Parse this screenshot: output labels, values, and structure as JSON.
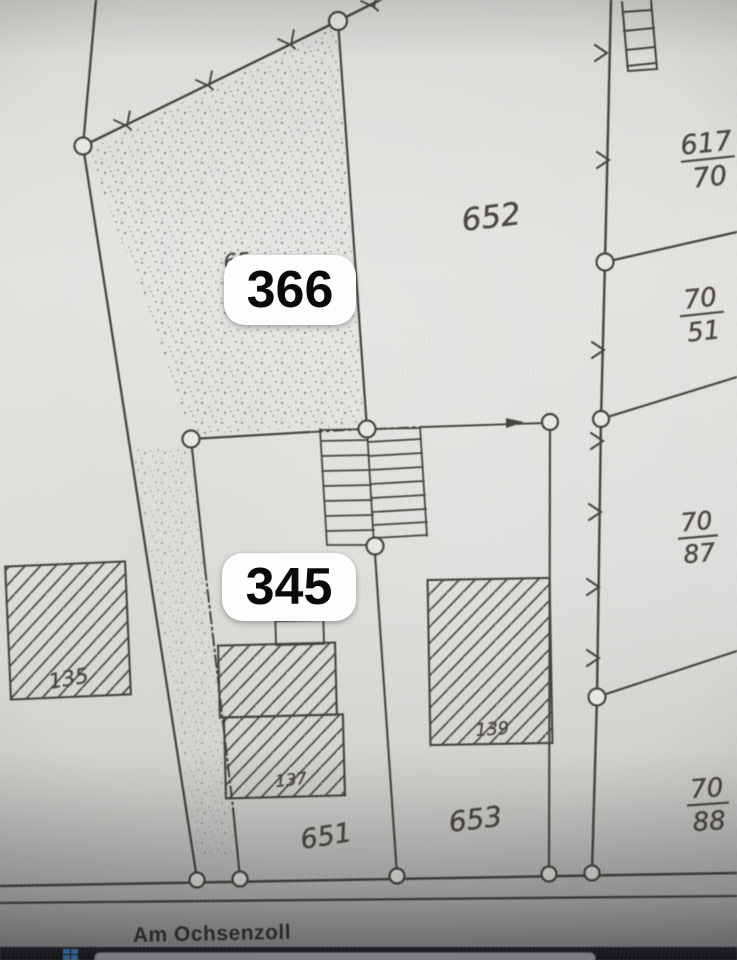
{
  "map": {
    "street_name": "Am Ochsenzoll",
    "annotation_pills": [
      {
        "text": "366"
      },
      {
        "text": "345"
      }
    ],
    "parcel_labels": [
      {
        "text": "652"
      },
      {
        "text": "651"
      },
      {
        "text": "653"
      }
    ],
    "partial_parcel_label": {
      "text": "65"
    },
    "fraction_labels": [
      {
        "numerator": "617",
        "denominator": "70"
      },
      {
        "numerator": "70",
        "denominator": "51"
      },
      {
        "numerator": "70",
        "denominator": "87"
      },
      {
        "numerator": "70",
        "denominator": "88"
      }
    ],
    "building_labels": [
      {
        "text": "135"
      },
      {
        "text": "137"
      },
      {
        "text": "139"
      }
    ]
  },
  "colors": {
    "paper": "#e2e1de",
    "map_ink": "#46433e",
    "pill_background": "#fdfdfd",
    "pill_text": "#0a0a0b",
    "taskbar_background": "#1e1f24",
    "windows_icon_blue": "#4a9be8",
    "taskbar_search_background": "#d0d1d4"
  }
}
